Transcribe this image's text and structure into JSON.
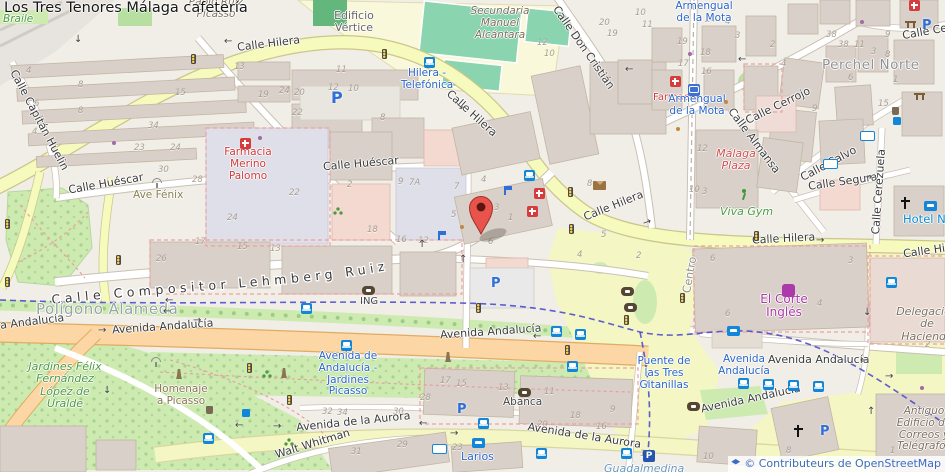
{
  "title": "Los Tres Tenores Málaga cafetería",
  "attribution": {
    "text": "© Contributeurs de OpenStreetMap"
  },
  "icons": {
    "parking_label": "P",
    "arrow_left": "←",
    "arrow_right": "→",
    "arrow_up": "↑",
    "arrow_down": "↓"
  },
  "streets": {
    "calle_hilera": "Calle Hilera",
    "calle_huescar": "Calle Huéscar",
    "calle_compositor": "Calle Compositor Lehmberg Ruiz",
    "calle_don_cristian": "Calle Don Cristián",
    "calle_cerrojo": "Calle Cerrojo",
    "calle_almansa": "Calle Almansa",
    "calle_calvo": "Calle Calvo",
    "calle_segura": "Calle Segura",
    "calle_cerezuela": "Calle Cerezuela",
    "calle_capitan_huelin": "Calle Capitán Huelin",
    "avenida_andalucia": "Avenida Andalucía",
    "a_andalucia": "a Andalucía",
    "avenida_de_la_aurora": "Avenida de la Aurora",
    "walt_whitman": "Walt Whitman"
  },
  "places": {
    "perchel_norte": "Perchel Norte",
    "poligono_alameda": "Polígono Alameda",
    "centro": "Centro",
    "edificio_vertice": "Edificio Vértice",
    "pablo_ruiz_picasso": "Pablo Ruiz Picasso",
    "braile": "Braile",
    "secundaria": "Secundaria Manuel Alcántara",
    "jardines_felix": "Jardines Félix Fernández López de Uralde",
    "homenaje_a_picasso": "Homenaje a Picasso",
    "delegacion": "Delegación de Hacienda",
    "antiguo_correos": "Antiguo Edificio de Correos y Telégrafos",
    "guadalmedina": "Guadalmedina"
  },
  "pois": {
    "farmacia_merino": "Farmacia Merino Palomo",
    "farmacia": "Farmacia",
    "ave_fenix": "Ave Fénix",
    "malaga_plaza": "Málaga Plaza",
    "viva_gym": "Viva Gym",
    "el_corte_ingles": "El Corte Inglés",
    "hotel_nh": "Hotel NH",
    "ing": "ING",
    "abanca": "Abanca"
  },
  "transit": {
    "hilera_telefonica": "Hilera - Telefónica",
    "armengual": "Armengual de la Mota",
    "avenida_andalucia_stop": "Avenida Andalucía",
    "jardines_picasso_stop": "Avenida de Andalucía - Jardines Picasso",
    "larios": "Larios",
    "puente": "Puente de las Tres Gitanillas"
  },
  "house_numbers": [
    "13",
    "4",
    "8",
    "15",
    "6",
    "8",
    "4",
    "19",
    "24",
    "20",
    "22",
    "34",
    "23",
    "24",
    "30",
    "28",
    "2",
    "22",
    "24",
    "17",
    "15",
    "13",
    "26",
    "18",
    "16",
    "12",
    "9",
    "7A",
    "7",
    "4",
    "3",
    "1",
    "6",
    "5",
    "8",
    "5",
    "4",
    "2",
    "11",
    "12",
    "10",
    "8",
    "12",
    "10",
    "20",
    "19",
    "10",
    "11",
    "24",
    "4",
    "3",
    "19",
    "18",
    "17",
    "16",
    "2",
    "4",
    "38",
    "38",
    "11",
    "3",
    "8",
    "9",
    "6",
    "15",
    "1",
    "12",
    "10",
    "3",
    "9",
    "6",
    "3",
    "4",
    "6",
    "2",
    "17",
    "15",
    "13",
    "11",
    "28",
    "30",
    "32",
    "34",
    "31",
    "29",
    "23",
    "20",
    "18",
    "16",
    "9",
    "14",
    "10",
    "8",
    "1"
  ]
}
